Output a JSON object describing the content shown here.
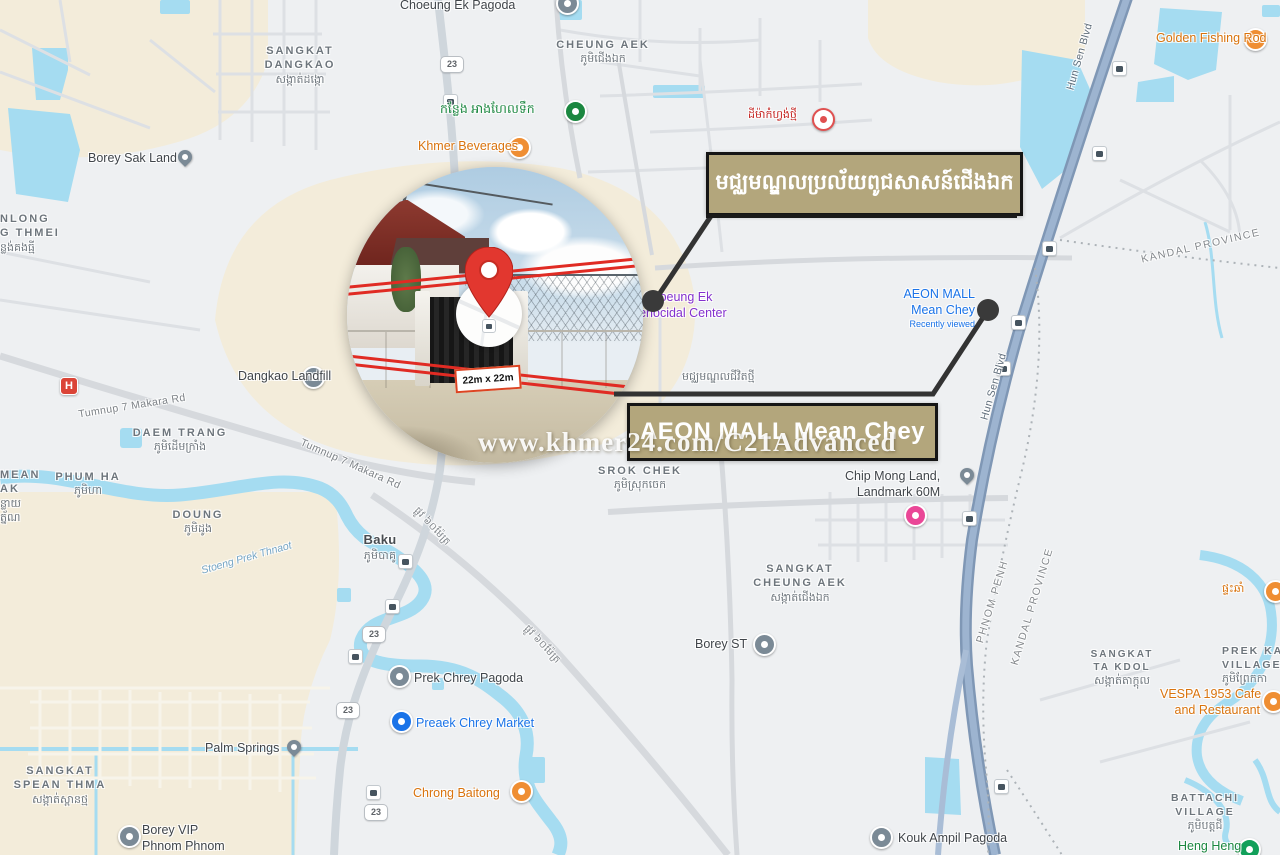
{
  "annotations": {
    "khmer_box_label": "មជ្ឈមណ្ឌលប្រល័យពូជសាសន៍ជើងឯក",
    "aeon_box_label": "AEON MALL Mean Chey",
    "plot_size_label": "22m x 22m",
    "watermark": "www.khmer24.com/C21Advanced",
    "box_bg_color": "#b3a67c",
    "box_border_color": "#151515",
    "connector_color": "#333333",
    "pin_color": "#e2372f"
  },
  "map": {
    "colors": {
      "background": "#eef0f2",
      "beige": "#f3ecda",
      "water": "#a5dcf1",
      "boulevard": "#8ba3c1",
      "road": "#d6d9dd",
      "orange_poi": "#d9730d",
      "green_poi": "#1b8740",
      "blue_poi": "#1a73e8",
      "purple_poi": "#8430ce",
      "pink_poi": "#ea4797",
      "gray_poi": "#7b8a96"
    },
    "route_shield": "23",
    "road_labels": {
      "tumnup": "Tumnup 7 Makara Rd",
      "hun_sen": "Hun Sen Blvd",
      "street60": "ផ្លូវ ៦០ម៉ែត្រ",
      "river": "Stoeng Prek Thnaot"
    },
    "boundary_labels": {
      "phnom_penh": "PHNOM PENH",
      "kandal": "KANDAL PROVINCE"
    },
    "areas": {
      "sangkat_dangkao": {
        "en1": "SANGKAT",
        "en2": "DANGKAO",
        "km": "សង្កាត់ដង្កោ"
      },
      "cheung_aek_village": {
        "en": "CHEUNG AEK",
        "km": "ភូមិជើងឯក"
      },
      "anlong_fragment": {
        "en1": "NLONG",
        "en2": "G THMEI",
        "km": "ន្លង់គងធ្មី"
      },
      "daem_trang": {
        "en": "DAEM TRANG",
        "km": "ភូមិដើមក្រាំង"
      },
      "mean_fragment": {
        "en1": "MEAN",
        "en2": "AK",
        "km1": "ន្លាយ",
        "km2": "ត្ន័ណ"
      },
      "phum_ha": {
        "en": "PHUM HA",
        "km": "ភូមិហា"
      },
      "doung": {
        "en": "DOUNG",
        "km": "ភូមិដូង"
      },
      "baku": {
        "en": "Baku",
        "km": "ភូមិបាគូ"
      },
      "srok_chek": {
        "en": "SROK CHEK",
        "km": "ភូមិស្រុកចេក"
      },
      "sangkat_cheung_aek": {
        "en1": "SANGKAT",
        "en2": "CHEUNG AEK",
        "km": "សង្កាត់ជើងឯក"
      },
      "sangkat_spean_thma": {
        "en1": "SANGKAT",
        "en2": "SPEAN THMA",
        "km": "សង្កាត់ស្ពានថ្ម"
      },
      "sangkat_ta_kdol": {
        "en1": "SANGKAT",
        "en2": "TA KDOL",
        "km": "សង្កាត់តាក្ដុល"
      },
      "battachi": {
        "en1": "BATTACHI",
        "en2": "VILLAGE",
        "km": "ភូមិបត្តជី"
      },
      "prek_ka": {
        "en1": "PREK KA",
        "en2": "VILLAGE",
        "km": "ភូមិព្រែកកា"
      }
    },
    "pois": {
      "choeung_ek_pagoda": "Choeung Ek Pagoda",
      "borey_sak_land": "Borey Sak Land",
      "swimming_pool": "កន្លែង អាងហែលទឹក",
      "land_new": "ដីម៉ាកំហ្វង់ថ្មី",
      "khmer_beverages": "Khmer Beverages",
      "golden_fishing_rod": "Golden Fishing Rod",
      "dangkao_landfill": "Dangkao Landfill",
      "genocidal1": "Choeung Ek",
      "genocidal2": "Genocidal Center",
      "aeon1": "AEON MALL",
      "aeon2": "Mean Chey",
      "aeon_sub": "Recently viewed",
      "new_life_center": "មជ្ឈមណ្ឌលជីវិតថ្មី",
      "chip_mong1": "Chip Mong Land,",
      "chip_mong2": "Landmark 60M",
      "borey_st": "Borey ST",
      "palm_springs": "Palm Springs",
      "borey_vip1": "Borey VIP",
      "borey_vip2": "Phnom Phnom",
      "prek_chrey_pagoda": "Prek Chrey Pagoda",
      "preaek_chrey_market": "Preaek Chrey Market",
      "chrong_baitong": "Chrong Baitong",
      "kouk_ampil_pagoda": "Kouk Ampil Pagoda",
      "vespa1": "VESPA 1953 Cafe",
      "vespa2": "and Restaurant",
      "heng_heng": "Heng Heng",
      "phteah_cham": "ផ្ទះឆាំ"
    }
  }
}
